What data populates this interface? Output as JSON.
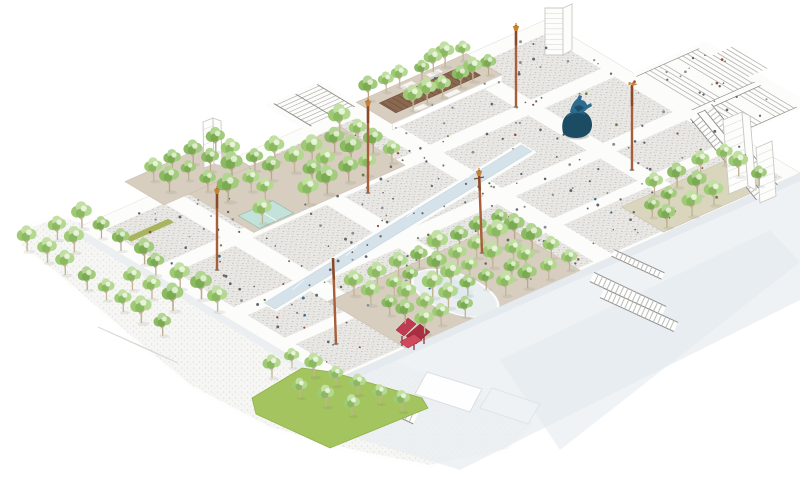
{
  "meta": {
    "title": "Axonometric masterplan rendering of a large public plaza with tree groves, light masts, stairs, escalators, a statue and a red sculpture",
    "type": "architectural-axonometric-diagram"
  },
  "palette": {
    "background": "#ffffff",
    "panel_base": "#e9e8e5",
    "panel_dot_dark": "#bdbab5",
    "panel_dot_mid": "#cfccc7",
    "panel_dot_deep": "#b1aeaa",
    "ground_base": "#f6f5f3",
    "ground_dot": "#e0ded9",
    "ground_dot2": "#e7e5e1",
    "walk_white": "#fcfcfb",
    "tan_ground": "#d8cec0",
    "tan_edge": "#c8bca9",
    "tan_green_ground": "#d9d6bd",
    "pergola_roof": "#8a6750",
    "pergola_slat": "#6f4f3a",
    "kiosk_glass": "#c3e2d9",
    "kiosk_frame": "#8fb7ac",
    "water": "#d6e2e9",
    "water_edge": "#b9cdd8",
    "playground": "#e9eef0",
    "playground_inner": "#dfeaee",
    "lawn": "#a3c45e",
    "lawn_edge": "#8fb04c",
    "bench_olive": "#a9b55c",
    "tree_green_1": "#8cba63",
    "tree_green_2": "#a2cb7e",
    "tree_green_3": "#b2d593",
    "tree_green_dark": "#7aab52",
    "tree_highlight": "#e2efd2",
    "trunk": "#b9aa8d",
    "pole_shaft": "#a65f3a",
    "pole_dark": "#8a4a28",
    "pole_finial": "#c8822f",
    "statue_dark": "#1c4c63",
    "statue_mid": "#2d6b8f",
    "statue_deep": "#174b66",
    "sculpture_red": "#c23a50",
    "sculpture_red_dark": "#a92e44",
    "sculpture_red_light": "#d04a5e",
    "stair_tread": "#b6b4b0",
    "stair_rail": "#898783",
    "ladder_rail": "#8f8e8a",
    "ladder_rung": "#bfbdb9",
    "wireframe": "#c9c8c5",
    "deck_pale": "#e9eef2",
    "deck_pale2": "#dfe7ed",
    "edge_face": "#eceff1",
    "edge_face2": "#e4eaee",
    "person_dark": "#62666b",
    "person_light": "#8b8e91",
    "person_blue": "#3b6e8c",
    "person_red": "#9a4a42",
    "person_olive": "#6f7d46"
  },
  "scene": {
    "iso": [
      0.75,
      0.45,
      -0.9,
      0.4,
      545,
      20
    ],
    "ground_polygon": [
      [
        60,
        214
      ],
      [
        130,
        233
      ],
      [
        200,
        262
      ],
      [
        268,
        300
      ],
      [
        330,
        335
      ],
      [
        405,
        362
      ],
      [
        470,
        390
      ],
      [
        540,
        422
      ],
      [
        508,
        452
      ],
      [
        430,
        468
      ],
      [
        350,
        452
      ],
      [
        270,
        430
      ],
      [
        190,
        388
      ],
      [
        120,
        330
      ],
      [
        52,
        272
      ],
      [
        18,
        246
      ],
      [
        26,
        226
      ]
    ],
    "ground_hatch": {
      "x": 98,
      "y": 327,
      "dx": 44,
      "dy": 20,
      "rows": 5,
      "ox": 9,
      "oy": 4
    },
    "lower_deck": [
      {
        "points": [
          [
            332,
            384
          ],
          [
            800,
            176
          ],
          [
            800,
            300
          ],
          [
            460,
            470
          ],
          [
            330,
            430
          ]
        ],
        "opacity": 0.75,
        "color_key": "deck_pale"
      },
      {
        "points": [
          [
            500,
            360
          ],
          [
            770,
            230
          ],
          [
            800,
            262
          ],
          [
            560,
            450
          ]
        ],
        "opacity": 0.5,
        "color_key": "deck_pale2"
      }
    ],
    "platform": {
      "u": [
        0,
        340
      ],
      "v": [
        0,
        520
      ]
    },
    "panel_u_spans": [
      [
        18,
        94
      ],
      [
        112,
        190
      ],
      [
        208,
        258
      ],
      [
        272,
        336
      ]
    ],
    "panel_v_spans": [
      [
        16,
        94
      ],
      [
        112,
        206
      ],
      [
        226,
        316
      ],
      [
        336,
        418
      ],
      [
        438,
        504
      ]
    ],
    "groves": [
      {
        "name": "pergola-grove",
        "rect": [
          -2,
          86,
          46,
          208
        ],
        "fill_key": "tan_ground"
      },
      {
        "name": "west-grove",
        "rect": [
          20,
          244,
          106,
          412
        ],
        "fill_key": "tan_ground"
      },
      {
        "name": "west-grove-wedge",
        "rect": [
          -32,
          344,
          20,
          440
        ],
        "fill_key": "tan_ground"
      },
      {
        "name": "south-grove",
        "rect": [
          236,
          244,
          340,
          438
        ],
        "fill_key": "tan_ground"
      },
      {
        "name": "east-grove",
        "rect": [
          282,
          32,
          338,
          150
        ],
        "fill_key": "tan_green_ground"
      }
    ],
    "grove_a_face": {
      "u": 46,
      "v1": 86,
      "v2": 208,
      "drop": 6
    },
    "pergola": {
      "rect": [
        12,
        100,
        34,
        194
      ],
      "slat_step": 6
    },
    "benches_white": [
      [
        2,
        120,
        8,
        134
      ],
      [
        2,
        150,
        8,
        164
      ],
      [
        38,
        130,
        44,
        144
      ],
      [
        38,
        166,
        44,
        180
      ]
    ],
    "bench_olive_rect": [
      40,
      452,
      48,
      500
    ],
    "kiosk": {
      "rect": [
        76,
        366,
        104,
        404
      ]
    },
    "channel": {
      "outer": [
        [
          142,
          146
        ],
        [
          164,
          146
        ],
        [
          220,
          482
        ],
        [
          198,
          482
        ]
      ],
      "inner": [
        [
          146,
          148
        ],
        [
          160,
          148
        ],
        [
          216,
          480
        ],
        [
          202,
          480
        ]
      ],
      "sparkles": [
        [
          155,
          200
        ],
        [
          170,
          280
        ],
        [
          185,
          360
        ],
        [
          198,
          430
        ]
      ]
    },
    "playground": {
      "cx": 298,
      "cy": 348,
      "rx": 48,
      "ry": 26,
      "icx": 292,
      "icy": 344,
      "irx": 20,
      "iry": 12
    },
    "grand_stairs": {
      "underlay": [
        [
          118,
          -80
        ],
        [
          258,
          -80
        ],
        [
          258,
          4
        ],
        [
          118,
          4
        ]
      ],
      "flights": [
        {
          "u1": 124,
          "u2": 198,
          "v1": -8,
          "v2": -66,
          "step": 5.2
        },
        {
          "u1": 206,
          "u2": 254,
          "v1": -8,
          "v2": -66,
          "step": 5.2
        },
        {
          "u1": 140,
          "u2": 188,
          "v1": -70,
          "v2": -94,
          "step": 5.0
        }
      ],
      "landing": [
        124,
        -40,
        254,
        -30
      ],
      "rails": [
        124,
        198,
        206,
        254
      ],
      "rail_v1": -68,
      "rail_v2": 2
    },
    "nw_stairs": {
      "underlay": [
        [
          -50,
          208
        ],
        [
          6,
          208
        ],
        [
          6,
          270
        ],
        [
          -50,
          270
        ]
      ],
      "tread_u1": -44,
      "tread_u2": 0,
      "tread_step": 5.5,
      "v1": 214,
      "v2": 262,
      "rails": [
        214,
        238,
        262
      ]
    },
    "ladders": [
      {
        "name": "escalator-east-1",
        "x1": 694,
        "y1": 116,
        "x2": 760,
        "y2": 197,
        "w": 9
      },
      {
        "name": "escalator-east-2",
        "x1": 708,
        "y1": 107,
        "x2": 774,
        "y2": 188,
        "w": 9
      },
      {
        "name": "stairs-southeast-1",
        "x1": 592,
        "y1": 277,
        "x2": 664,
        "y2": 311,
        "w": 10
      },
      {
        "name": "stairs-southeast-2",
        "x1": 602,
        "y1": 293,
        "x2": 676,
        "y2": 327,
        "w": 10
      },
      {
        "name": "stairs-southeast-3",
        "x1": 613,
        "y1": 253,
        "x2": 663,
        "y2": 276,
        "w": 7
      },
      {
        "name": "stairs-south-entrance",
        "x1": 354,
        "y1": 389,
        "x2": 416,
        "y2": 418,
        "w": 13
      }
    ],
    "ramps": [
      {
        "points": [
          [
            427,
            372
          ],
          [
            482,
            389
          ],
          [
            470,
            412
          ],
          [
            415,
            394
          ]
        ],
        "fill": "#ffffff",
        "stroke": "#d9dee2",
        "opacity": 0.95
      },
      {
        "points": [
          [
            492,
            388
          ],
          [
            540,
            404
          ],
          [
            528,
            424
          ],
          [
            480,
            408
          ]
        ],
        "fill": "#eef3f6",
        "stroke": "#dbe2e6",
        "opacity": 0.8
      }
    ],
    "edge_faces": [
      {
        "points": [
          [
            77,
            228
          ],
          [
            332,
            381
          ],
          [
            332,
            389
          ],
          [
            77,
            236
          ]
        ],
        "color_key": "edge_face"
      },
      {
        "points": [
          [
            332,
            381
          ],
          [
            800,
            173
          ],
          [
            800,
            181
          ],
          [
            332,
            389
          ]
        ],
        "color_key": "edge_face2"
      }
    ],
    "lawn": {
      "points": [
        [
          252,
          398
        ],
        [
          302,
          368
        ],
        [
          332,
          372
        ],
        [
          422,
          398
        ],
        [
          428,
          408
        ],
        [
          330,
          448
        ],
        [
          256,
          414
        ]
      ],
      "trees": [
        [
          272,
          378
        ],
        [
          292,
          368
        ],
        [
          314,
          377
        ],
        [
          336,
          386
        ],
        [
          358,
          395
        ],
        [
          380,
          404
        ],
        [
          402,
          412
        ],
        [
          300,
          398
        ],
        [
          326,
          407
        ],
        [
          352,
          416
        ]
      ]
    },
    "buildings": [
      {
        "name": "tower-north",
        "front": [
          [
            545,
            8
          ],
          [
            563,
            8
          ],
          [
            563,
            55
          ],
          [
            545,
            55
          ]
        ],
        "side": [
          [
            563,
            8
          ],
          [
            572,
            4
          ],
          [
            572,
            50
          ],
          [
            563,
            55
          ]
        ],
        "hlines": 9
      },
      {
        "name": "tower-east",
        "front": [
          [
            723,
            120
          ],
          [
            742,
            112
          ],
          [
            748,
            186
          ],
          [
            729,
            194
          ]
        ],
        "side": [
          [
            742,
            112
          ],
          [
            750,
            116
          ],
          [
            756,
            190
          ],
          [
            748,
            186
          ]
        ],
        "hlines": 10
      },
      {
        "name": "tower-west",
        "front": [
          [
            203,
            122
          ],
          [
            213,
            118
          ],
          [
            214,
            164
          ],
          [
            204,
            168
          ]
        ],
        "side": [
          [
            213,
            118
          ],
          [
            221,
            121
          ],
          [
            222,
            166
          ],
          [
            214,
            164
          ]
        ],
        "hlines": 6
      },
      {
        "name": "tower-far-east",
        "front": [
          [
            756,
            148
          ],
          [
            772,
            141
          ],
          [
            776,
            196
          ],
          [
            760,
            203
          ]
        ],
        "side": [],
        "hlines": 7
      }
    ],
    "tree_grids": [
      {
        "name": "pergola-grove-trees",
        "rows_u": [
          4,
          40
        ],
        "v1": 94,
        "v2": 202,
        "step": 17,
        "scale": 1.1,
        "variant_mix": 0.5
      },
      {
        "name": "west-grove-trees",
        "rows_u": [
          26,
          50,
          74,
          98
        ],
        "v1": 252,
        "v2": 406,
        "step": 24,
        "scale": 1.25,
        "variant_mix": 0.5
      },
      {
        "name": "west-wedge-trees",
        "rows_u": [
          -16,
          4
        ],
        "v1": 352,
        "v2": 432,
        "step": 24,
        "scale": 1.15,
        "variant_mix": 0.5
      },
      {
        "name": "south-grove-trees",
        "rows_u": [
          244,
          266,
          288,
          310,
          332
        ],
        "v1": 252,
        "v2": 430,
        "step": 23,
        "scale": 1.2,
        "variant_mix": 0.5
      },
      {
        "name": "east-grove-trees",
        "rows_u": [
          288,
          310,
          332
        ],
        "v1": 42,
        "v2": 142,
        "step": 25,
        "scale": 1.15,
        "variant_mix": 0.5
      },
      {
        "name": "street-tree-rows",
        "rows_u": [
          4,
          30,
          56
        ],
        "v1": 516,
        "v2": 600,
        "step": 0,
        "cols_u": [
          4,
          30,
          56,
          82,
          108,
          134,
          160,
          186
        ],
        "rows_v": [
          518,
          548,
          578
        ],
        "scale": 1.25,
        "variant_mix": 0.5
      }
    ],
    "poles": [
      {
        "x1": 516,
        "y1": 107,
        "x2": 516,
        "y2": 25,
        "finial": "cup"
      },
      {
        "x1": 632,
        "y1": 170,
        "x2": 632,
        "y2": 85,
        "finial": "bird"
      },
      {
        "x1": 368,
        "y1": 193,
        "x2": 368,
        "y2": 100,
        "finial": "cup"
      },
      {
        "x1": 217,
        "y1": 270,
        "x2": 217,
        "y2": 188,
        "finial": "cup"
      },
      {
        "x1": 336,
        "y1": 344,
        "x2": 333,
        "y2": 258,
        "finial": "plain"
      },
      {
        "x1": 482,
        "y1": 253,
        "x2": 479,
        "y2": 170,
        "finial": "cross"
      }
    ],
    "statue": {
      "cx": 576,
      "cy": 131
    },
    "sculpture": {
      "quads": [
        {
          "points": [
            [
              396,
              330
            ],
            [
              408,
              318
            ],
            [
              416,
              324
            ],
            [
              404,
              336
            ]
          ],
          "color_key": "sculpture_red"
        },
        {
          "points": [
            [
              406,
              336
            ],
            [
              420,
              324
            ],
            [
              430,
              332
            ],
            [
              416,
              344
            ]
          ],
          "color_key": "sculpture_red_dark"
        },
        {
          "points": [
            [
              400,
              342
            ],
            [
              414,
              334
            ],
            [
              422,
              340
            ],
            [
              408,
              348
            ]
          ],
          "color_key": "sculpture_red_light"
        }
      ],
      "legs": [
        [
          402,
          336,
          402,
          346
        ],
        [
          414,
          340,
          414,
          350
        ],
        [
          424,
          334,
          424,
          344
        ]
      ]
    },
    "people": {
      "seed": 7,
      "count": 230,
      "stair_count": 20,
      "color_weights": [
        [
          "person_dark",
          0.58
        ],
        [
          "person_light",
          0.2
        ],
        [
          "person_blue",
          0.08
        ],
        [
          "person_red",
          0.07
        ],
        [
          "person_olive",
          0.07
        ]
      ]
    }
  }
}
